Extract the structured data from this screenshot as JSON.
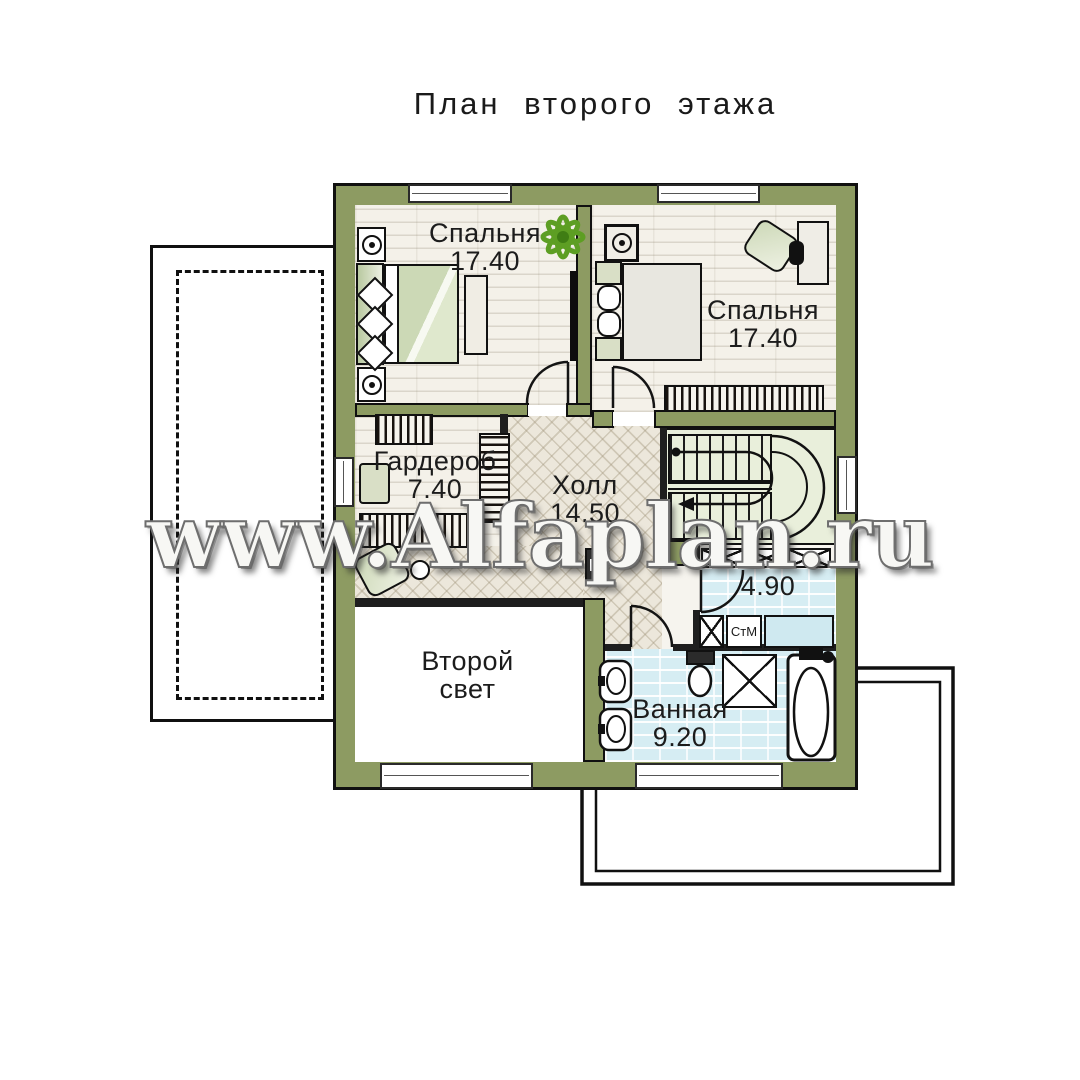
{
  "title": "План второго этажа",
  "watermark": "www.Alfaplan.ru",
  "rooms": {
    "bedroom_left": {
      "name": "Спальня",
      "area": "17.40"
    },
    "bedroom_right": {
      "name": "Спальня",
      "area": "17.40"
    },
    "wardrobe": {
      "name": "Гардероб",
      "area": "7.40"
    },
    "hall": {
      "name": "Холл",
      "area": "14.50"
    },
    "laundry": {
      "area": "4.90"
    },
    "bathroom": {
      "name": "Ванная",
      "area": "9.20"
    },
    "second_light": {
      "line1": "Второй",
      "line2": "свет"
    }
  },
  "fixtures": {
    "washing_machine": "СтМ"
  },
  "colors": {
    "wall_olive": "#8d9b62",
    "stair_floor": "#e9efdb",
    "wet_floor": "#d6edf3",
    "plank_floor": "#f4f1e9",
    "tile_floor": "#ece7db",
    "plant_green": "#5d9e23"
  }
}
